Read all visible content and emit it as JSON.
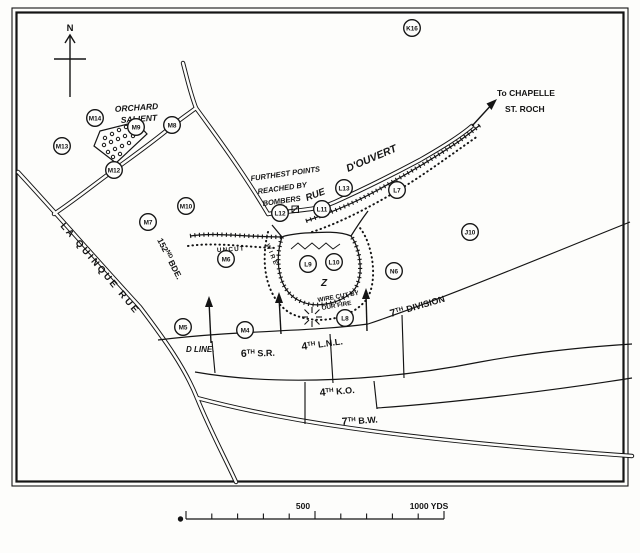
{
  "compass": {
    "label": "N"
  },
  "labels": {
    "orchard_line1": "ORCHARD",
    "orchard_line2": "SALIENT",
    "furthest_line1": "FURTHEST POINTS",
    "furthest_line2": "REACHED BY",
    "furthest_line3": "BOMBERS",
    "rue": "RUE",
    "douvert": "D'OUVERT",
    "chapelle_line1": "To CHAPELLE",
    "chapelle_line2": "ST. ROCH",
    "quinque": "LA QUINQUE RUE",
    "uncut": "UNCUT",
    "wire": "WIRE",
    "wirecut_line1": "WIRE CUT BY",
    "wirecut_line2": "OUR FIRE",
    "z": "Z",
    "dline": "D LINE."
  },
  "units": {
    "bde": {
      "num": "152",
      "sup": "ND",
      "rest": "BDE."
    },
    "division": {
      "num": "7",
      "sup": "TH",
      "rest": "DIVISION"
    },
    "sr": {
      "num": "6",
      "sup": "TH",
      "rest": "S.R."
    },
    "lnl": {
      "num": "4",
      "sup": "TH",
      "rest": "L.N.L."
    },
    "ko": {
      "num": "4",
      "sup": "TH",
      "rest": "K.O."
    },
    "bw": {
      "num": "7",
      "sup": "TH",
      "rest": "B.W."
    }
  },
  "points": [
    {
      "label": "K16"
    },
    {
      "label": "M14"
    },
    {
      "label": "M9"
    },
    {
      "label": "M8"
    },
    {
      "label": "M13"
    },
    {
      "label": "M12"
    },
    {
      "label": "M10"
    },
    {
      "label": "M7"
    },
    {
      "label": "M6"
    },
    {
      "label": "M5"
    },
    {
      "label": "M4"
    },
    {
      "label": "L12"
    },
    {
      "label": "L11"
    },
    {
      "label": "L13"
    },
    {
      "label": "L7"
    },
    {
      "label": "L9"
    },
    {
      "label": "L10"
    },
    {
      "label": "L8"
    },
    {
      "label": "N6"
    },
    {
      "label": "J10"
    }
  ],
  "scale": {
    "mid_label": "500",
    "end_label": "1000 YDS"
  }
}
